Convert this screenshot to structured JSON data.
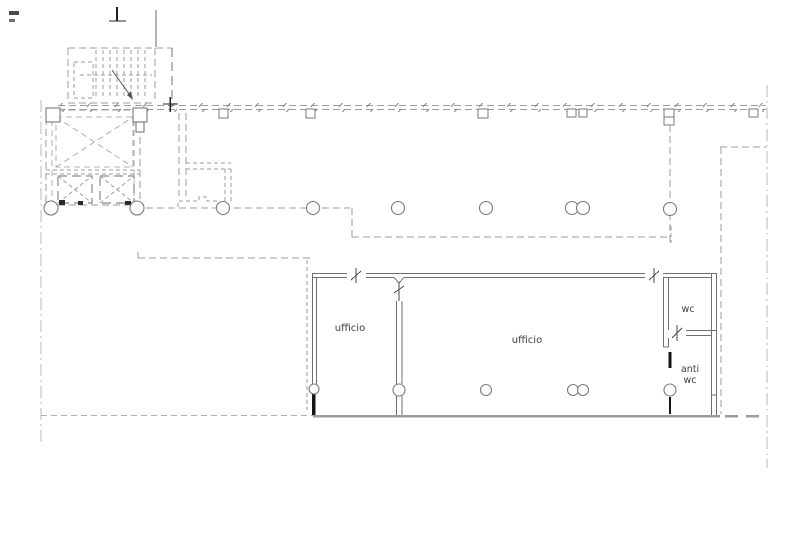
{
  "floor_plan": {
    "background_color": "#ffffff",
    "line_color_dashed": "#9d9d9d",
    "line_color_wall": "#6e6e6e",
    "line_color_grid": "#b8b8b8",
    "line_color_heavy": "#1c1c1c",
    "bottom_wall_color": "#9c9c9c",
    "text_color": "#3c3c3c",
    "labels": {
      "office_left": "ufficio",
      "office_main": "ufficio",
      "wc": "wc",
      "anti_wc_line1": "anti",
      "anti_wc_line2": "wc"
    }
  }
}
